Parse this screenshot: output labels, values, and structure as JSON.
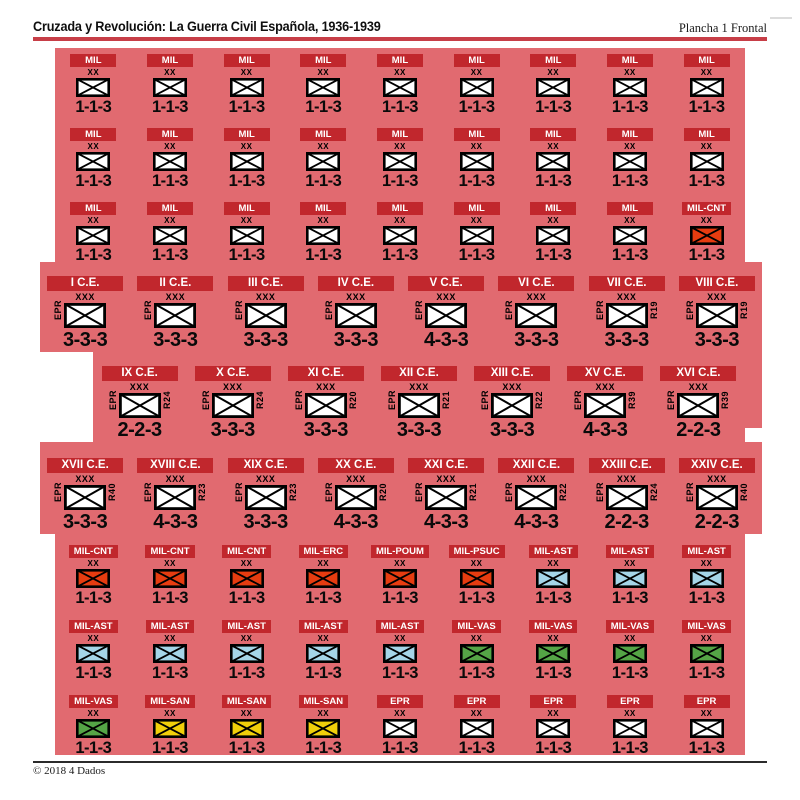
{
  "header": {
    "title": "Cruzada y Revolución: La Guerra Civil Española, 1936-1939",
    "sheet_label": "Plancha 1 Frontal"
  },
  "footer": {
    "copyright": "© 2018 4 Dados"
  },
  "colors": {
    "sheet_pink": "#e16a70",
    "banner_red": "#c1272d",
    "rule_red": "#c73e47",
    "box_white": "#ffffff",
    "box_red": "#e63c10",
    "box_blue": "#a5d5e8",
    "box_green": "#55a546",
    "box_yellow": "#f0cf0a"
  },
  "rows": [
    {
      "kind": "mil",
      "counters": [
        {
          "label": "MIL",
          "echelon": "XX",
          "box": "white",
          "stats": "1-1-3"
        },
        {
          "label": "MIL",
          "echelon": "XX",
          "box": "white",
          "stats": "1-1-3"
        },
        {
          "label": "MIL",
          "echelon": "XX",
          "box": "white",
          "stats": "1-1-3"
        },
        {
          "label": "MIL",
          "echelon": "XX",
          "box": "white",
          "stats": "1-1-3"
        },
        {
          "label": "MIL",
          "echelon": "XX",
          "box": "white",
          "stats": "1-1-3"
        },
        {
          "label": "MIL",
          "echelon": "XX",
          "box": "white",
          "stats": "1-1-3"
        },
        {
          "label": "MIL",
          "echelon": "XX",
          "box": "white",
          "stats": "1-1-3"
        },
        {
          "label": "MIL",
          "echelon": "XX",
          "box": "white",
          "stats": "1-1-3"
        },
        {
          "label": "MIL",
          "echelon": "XX",
          "box": "white",
          "stats": "1-1-3"
        }
      ]
    },
    {
      "kind": "mil",
      "counters": [
        {
          "label": "MIL",
          "echelon": "XX",
          "box": "white",
          "stats": "1-1-3"
        },
        {
          "label": "MIL",
          "echelon": "XX",
          "box": "white",
          "stats": "1-1-3"
        },
        {
          "label": "MIL",
          "echelon": "XX",
          "box": "white",
          "stats": "1-1-3"
        },
        {
          "label": "MIL",
          "echelon": "XX",
          "box": "white",
          "stats": "1-1-3"
        },
        {
          "label": "MIL",
          "echelon": "XX",
          "box": "white",
          "stats": "1-1-3"
        },
        {
          "label": "MIL",
          "echelon": "XX",
          "box": "white",
          "stats": "1-1-3"
        },
        {
          "label": "MIL",
          "echelon": "XX",
          "box": "white",
          "stats": "1-1-3"
        },
        {
          "label": "MIL",
          "echelon": "XX",
          "box": "white",
          "stats": "1-1-3"
        },
        {
          "label": "MIL",
          "echelon": "XX",
          "box": "white",
          "stats": "1-1-3"
        }
      ]
    },
    {
      "kind": "mil",
      "counters": [
        {
          "label": "MIL",
          "echelon": "XX",
          "box": "white",
          "stats": "1-1-3"
        },
        {
          "label": "MIL",
          "echelon": "XX",
          "box": "white",
          "stats": "1-1-3"
        },
        {
          "label": "MIL",
          "echelon": "XX",
          "box": "white",
          "stats": "1-1-3"
        },
        {
          "label": "MIL",
          "echelon": "XX",
          "box": "white",
          "stats": "1-1-3"
        },
        {
          "label": "MIL",
          "echelon": "XX",
          "box": "white",
          "stats": "1-1-3"
        },
        {
          "label": "MIL",
          "echelon": "XX",
          "box": "white",
          "stats": "1-1-3"
        },
        {
          "label": "MIL",
          "echelon": "XX",
          "box": "white",
          "stats": "1-1-3"
        },
        {
          "label": "MIL",
          "echelon": "XX",
          "box": "white",
          "stats": "1-1-3"
        },
        {
          "label": "MIL-CNT",
          "echelon": "XX",
          "box": "red",
          "stats": "1-1-3"
        }
      ]
    },
    {
      "kind": "ce",
      "counters": [
        {
          "label": "I C.E.",
          "echelon": "XXX",
          "unit": "EPR",
          "ref": "",
          "box": "white",
          "stats": "3-3-3"
        },
        {
          "label": "II C.E.",
          "echelon": "XXX",
          "unit": "EPR",
          "ref": "",
          "box": "white",
          "stats": "3-3-3"
        },
        {
          "label": "III C.E.",
          "echelon": "XXX",
          "unit": "EPR",
          "ref": "",
          "box": "white",
          "stats": "3-3-3"
        },
        {
          "label": "IV C.E.",
          "echelon": "XXX",
          "unit": "EPR",
          "ref": "",
          "box": "white",
          "stats": "3-3-3"
        },
        {
          "label": "V C.E.",
          "echelon": "XXX",
          "unit": "EPR",
          "ref": "",
          "box": "white",
          "stats": "4-3-3"
        },
        {
          "label": "VI C.E.",
          "echelon": "XXX",
          "unit": "EPR",
          "ref": "",
          "box": "white",
          "stats": "3-3-3"
        },
        {
          "label": "VII C.E.",
          "echelon": "XXX",
          "unit": "EPR",
          "ref": "R19",
          "box": "white",
          "stats": "3-3-3"
        },
        {
          "label": "VIII C.E.",
          "echelon": "XXX",
          "unit": "EPR",
          "ref": "R19",
          "box": "white",
          "stats": "3-3-3"
        }
      ]
    },
    {
      "kind": "ce",
      "counters": [
        {
          "label": "IX C.E.",
          "echelon": "XXX",
          "unit": "EPR",
          "ref": "R24",
          "box": "white",
          "stats": "2-2-3"
        },
        {
          "label": "X C.E.",
          "echelon": "XXX",
          "unit": "EPR",
          "ref": "R24",
          "box": "white",
          "stats": "3-3-3"
        },
        {
          "label": "XI C.E.",
          "echelon": "XXX",
          "unit": "EPR",
          "ref": "R20",
          "box": "white",
          "stats": "3-3-3"
        },
        {
          "label": "XII C.E.",
          "echelon": "XXX",
          "unit": "EPR",
          "ref": "R21",
          "box": "white",
          "stats": "3-3-3"
        },
        {
          "label": "XIII C.E.",
          "echelon": "XXX",
          "unit": "EPR",
          "ref": "R22",
          "box": "white",
          "stats": "3-3-3"
        },
        {
          "label": "XV C.E.",
          "echelon": "XXX",
          "unit": "EPR",
          "ref": "R39",
          "box": "white",
          "stats": "4-3-3"
        },
        {
          "label": "XVI C.E.",
          "echelon": "XXX",
          "unit": "EPR",
          "ref": "R39",
          "box": "white",
          "stats": "2-2-3"
        }
      ]
    },
    {
      "kind": "ce",
      "counters": [
        {
          "label": "XVII C.E.",
          "echelon": "XXX",
          "unit": "EPR",
          "ref": "R40",
          "box": "white",
          "stats": "3-3-3"
        },
        {
          "label": "XVIII C.E.",
          "echelon": "XXX",
          "unit": "EPR",
          "ref": "R23",
          "box": "white",
          "stats": "4-3-3"
        },
        {
          "label": "XIX C.E.",
          "echelon": "XXX",
          "unit": "EPR",
          "ref": "R23",
          "box": "white",
          "stats": "3-3-3"
        },
        {
          "label": "XX C.E.",
          "echelon": "XXX",
          "unit": "EPR",
          "ref": "R20",
          "box": "white",
          "stats": "4-3-3"
        },
        {
          "label": "XXI C.E.",
          "echelon": "XXX",
          "unit": "EPR",
          "ref": "R21",
          "box": "white",
          "stats": "4-3-3"
        },
        {
          "label": "XXII C.E.",
          "echelon": "XXX",
          "unit": "EPR",
          "ref": "R22",
          "box": "white",
          "stats": "4-3-3"
        },
        {
          "label": "XXIII C.E.",
          "echelon": "XXX",
          "unit": "EPR",
          "ref": "R24",
          "box": "white",
          "stats": "2-2-3"
        },
        {
          "label": "XXIV C.E.",
          "echelon": "XXX",
          "unit": "EPR",
          "ref": "R40",
          "box": "white",
          "stats": "2-2-3"
        }
      ]
    },
    {
      "kind": "mil",
      "counters": [
        {
          "label": "MIL-CNT",
          "echelon": "XX",
          "box": "red",
          "stats": "1-1-3"
        },
        {
          "label": "MIL-CNT",
          "echelon": "XX",
          "box": "red",
          "stats": "1-1-3"
        },
        {
          "label": "MIL-CNT",
          "echelon": "XX",
          "box": "red",
          "stats": "1-1-3"
        },
        {
          "label": "MIL-ERC",
          "echelon": "XX",
          "box": "red",
          "stats": "1-1-3"
        },
        {
          "label": "MIL-POUM",
          "echelon": "XX",
          "box": "red",
          "stats": "1-1-3"
        },
        {
          "label": "MIL-PSUC",
          "echelon": "XX",
          "box": "red",
          "stats": "1-1-3"
        },
        {
          "label": "MIL-AST",
          "echelon": "XX",
          "box": "blue",
          "stats": "1-1-3"
        },
        {
          "label": "MIL-AST",
          "echelon": "XX",
          "box": "blue",
          "stats": "1-1-3"
        },
        {
          "label": "MIL-AST",
          "echelon": "XX",
          "box": "blue",
          "stats": "1-1-3"
        }
      ]
    },
    {
      "kind": "mil",
      "counters": [
        {
          "label": "MIL-AST",
          "echelon": "XX",
          "box": "blue",
          "stats": "1-1-3"
        },
        {
          "label": "MIL-AST",
          "echelon": "XX",
          "box": "blue",
          "stats": "1-1-3"
        },
        {
          "label": "MIL-AST",
          "echelon": "XX",
          "box": "blue",
          "stats": "1-1-3"
        },
        {
          "label": "MIL-AST",
          "echelon": "XX",
          "box": "blue",
          "stats": "1-1-3"
        },
        {
          "label": "MIL-AST",
          "echelon": "XX",
          "box": "blue",
          "stats": "1-1-3"
        },
        {
          "label": "MIL-VAS",
          "echelon": "XX",
          "box": "green",
          "stats": "1-1-3"
        },
        {
          "label": "MIL-VAS",
          "echelon": "XX",
          "box": "green",
          "stats": "1-1-3"
        },
        {
          "label": "MIL-VAS",
          "echelon": "XX",
          "box": "green",
          "stats": "1-1-3"
        },
        {
          "label": "MIL-VAS",
          "echelon": "XX",
          "box": "green",
          "stats": "1-1-3"
        }
      ]
    },
    {
      "kind": "mil",
      "counters": [
        {
          "label": "MIL-VAS",
          "echelon": "XX",
          "box": "green",
          "stats": "1-1-3"
        },
        {
          "label": "MIL-SAN",
          "echelon": "XX",
          "box": "yellow",
          "stats": "1-1-3"
        },
        {
          "label": "MIL-SAN",
          "echelon": "XX",
          "box": "yellow",
          "stats": "1-1-3"
        },
        {
          "label": "MIL-SAN",
          "echelon": "XX",
          "box": "yellow",
          "stats": "1-1-3"
        },
        {
          "label": "EPR",
          "echelon": "XX",
          "box": "white",
          "stats": "1-1-3"
        },
        {
          "label": "EPR",
          "echelon": "XX",
          "box": "white",
          "stats": "1-1-3"
        },
        {
          "label": "EPR",
          "echelon": "XX",
          "box": "white",
          "stats": "1-1-3"
        },
        {
          "label": "EPR",
          "echelon": "XX",
          "box": "white",
          "stats": "1-1-3"
        },
        {
          "label": "EPR",
          "echelon": "XX",
          "box": "white",
          "stats": "1-1-3"
        }
      ]
    }
  ]
}
